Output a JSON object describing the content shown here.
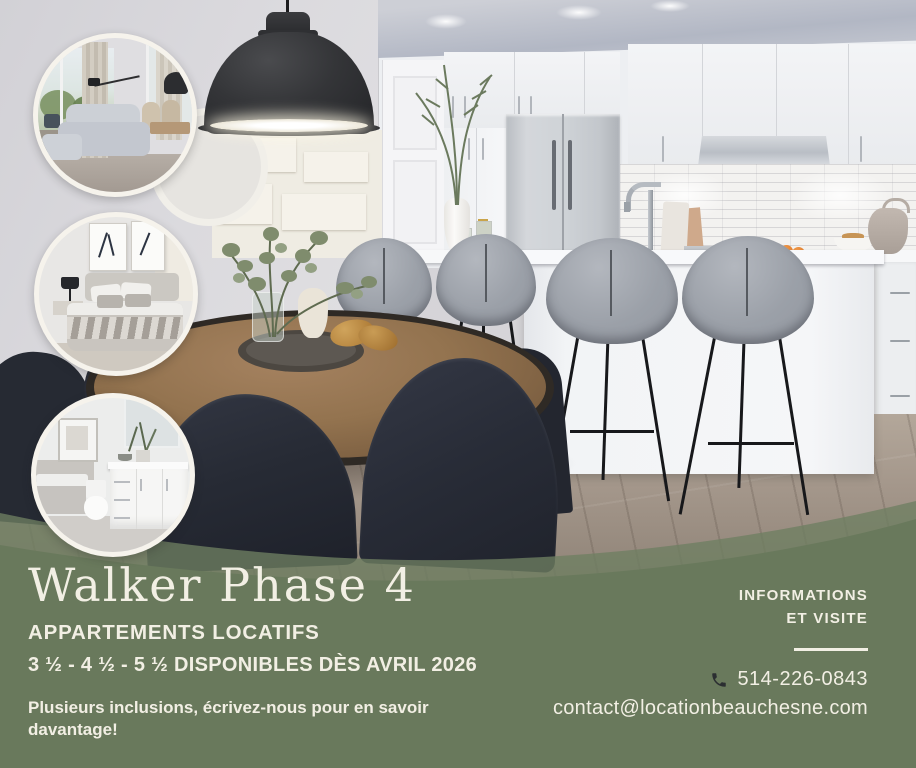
{
  "brand": {
    "title": "Walker Phase 4",
    "subtitle": "APPARTEMENTS LOCATIFS",
    "availability": "3 ½ - 4 ½ - 5 ½ DISPONIBLES DÈS AVRIL 2026",
    "note_line1": "Plusieurs inclusions, écrivez-nous pour en savoir",
    "note_line2": "davantage!"
  },
  "contact": {
    "heading_line1": "INFORMATIONS",
    "heading_line2": "ET VISITE",
    "phone": "514-226-0843",
    "email": "contact@locationbeauchesne.com"
  },
  "icons": {
    "phone": "phone-handset-icon"
  },
  "colors": {
    "band_green": "#69795c",
    "band_green_translucent": "#6e7f61",
    "text_cream": "#f2efe4",
    "phone_icon_dark": "#2b2e31"
  },
  "photos": {
    "main": "modern-kitchen-dining-room",
    "inset_top": "living-room",
    "inset_middle": "bedroom",
    "inset_bottom": "bathroom"
  }
}
